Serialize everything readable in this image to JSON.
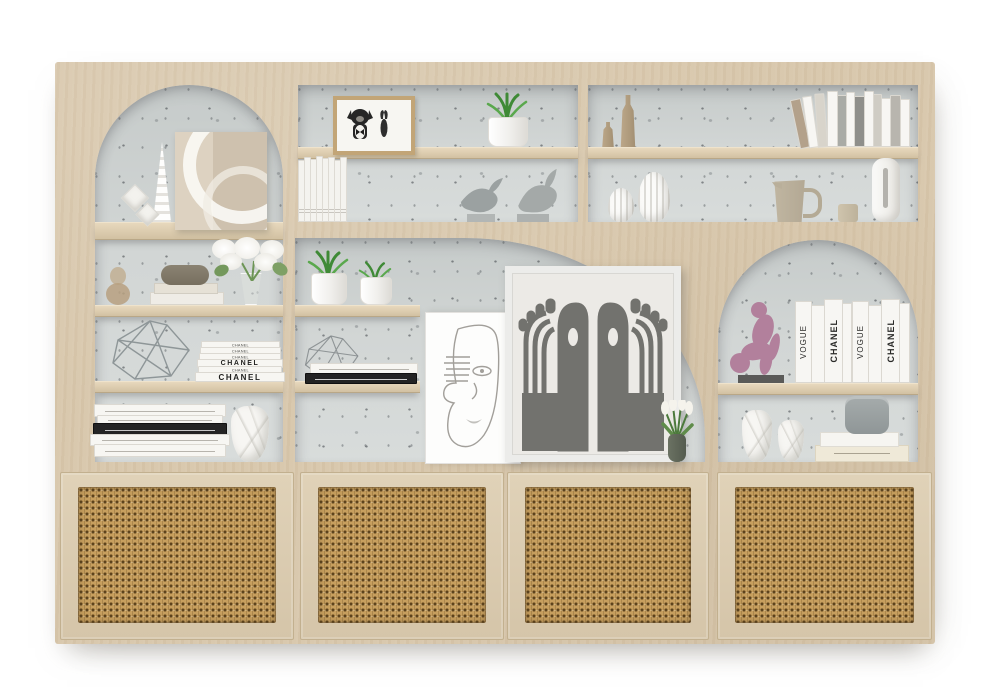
{
  "scene": {
    "description": "Light oak wall-unit bookshelf render with two arched niches, speckled concrete back panels, decorative styling objects and four rattan cane cabinet doors",
    "background_color": "#ffffff"
  },
  "palette": {
    "wood": "#d8c7ac",
    "wood_shelf": "#e0d1b6",
    "back_panel": "#ccd1d0",
    "cane": "#c79f5e",
    "plant_green": "#3f8a36",
    "figurine_pink": "#b2809c",
    "artwork_gray": "#72726e"
  },
  "books": {
    "chanel_stack": [
      "CHANEL",
      "CHANEL",
      "CHANEL",
      "CHANEL",
      "CHANEL",
      "CHANEL"
    ],
    "right_vertical": [
      "VOGUE",
      "CHANEL",
      "VOGUE",
      "CHANEL"
    ]
  },
  "objects": {
    "left_arch": [
      "spiral-cone-vase",
      "diamond-wall-decor",
      "abstract-arc-canvas"
    ],
    "left_column": [
      "hourglass-glass-vase",
      "book-and-box-stack",
      "white-hydrangea-bouquet",
      "wire-polyhedron-sculpture",
      "chanel-book-stack",
      "horizontal-book-stack",
      "white-faceted-vase"
    ],
    "middle_top": [
      "dog-portrait-frame",
      "potted-grass-plant",
      "white-book-row",
      "bird-figurines"
    ],
    "right_top": [
      "tan-bottle-vases",
      "leaning-book-row",
      "ribbed-gourd-vases",
      "beige-pitcher",
      "candle",
      "slot-vase"
    ],
    "center": [
      "potted-grass-plants",
      "wire-cube-sculpture",
      "two-book-stack",
      "line-art-face-canvas",
      "abstract-hands-artwork",
      "white-tulip-vase"
    ],
    "right_arch": [
      "pink-crouching-figurine",
      "vogue-chanel-book-row",
      "white-faceted-vases",
      "book-stack-with-gray-box"
    ],
    "cabinet": {
      "door_count": 4,
      "door_material": "cane-webbing"
    }
  }
}
